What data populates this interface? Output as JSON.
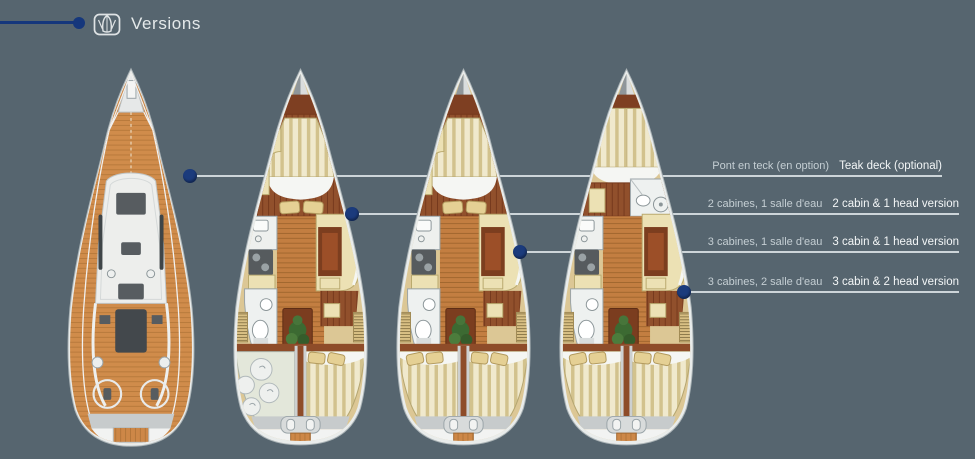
{
  "header": {
    "title": "Versions",
    "icon": "boat-versions-icon"
  },
  "annotations": [
    {
      "fr": "Pont en teck (en option)",
      "en": "Teak deck (optional)"
    },
    {
      "fr": "2 cabines, 1 salle d'eau",
      "en": "2 cabin & 1 head version"
    },
    {
      "fr": "3 cabines, 1 salle d'eau",
      "en": "3 cabin & 1 head version"
    },
    {
      "fr": "3 cabines, 2 salle d'eau",
      "en": "3 cabin & 2 head version"
    }
  ],
  "boats": [
    {
      "name": "teak-deck-plan"
    },
    {
      "name": "2-cabin-1-head-layout"
    },
    {
      "name": "3-cabin-1-head-layout"
    },
    {
      "name": "3-cabin-2-head-layout"
    }
  ],
  "colors": {
    "background": "#56656f",
    "accent_navy": "#15377c",
    "leader_line": "#cdd5d9",
    "label_fr": "#c4ced3",
    "label_en": "#f3f6f7",
    "teak": "#d08c4b",
    "dark_wood": "#91502c",
    "cushion_cream": "#ece1b4"
  }
}
